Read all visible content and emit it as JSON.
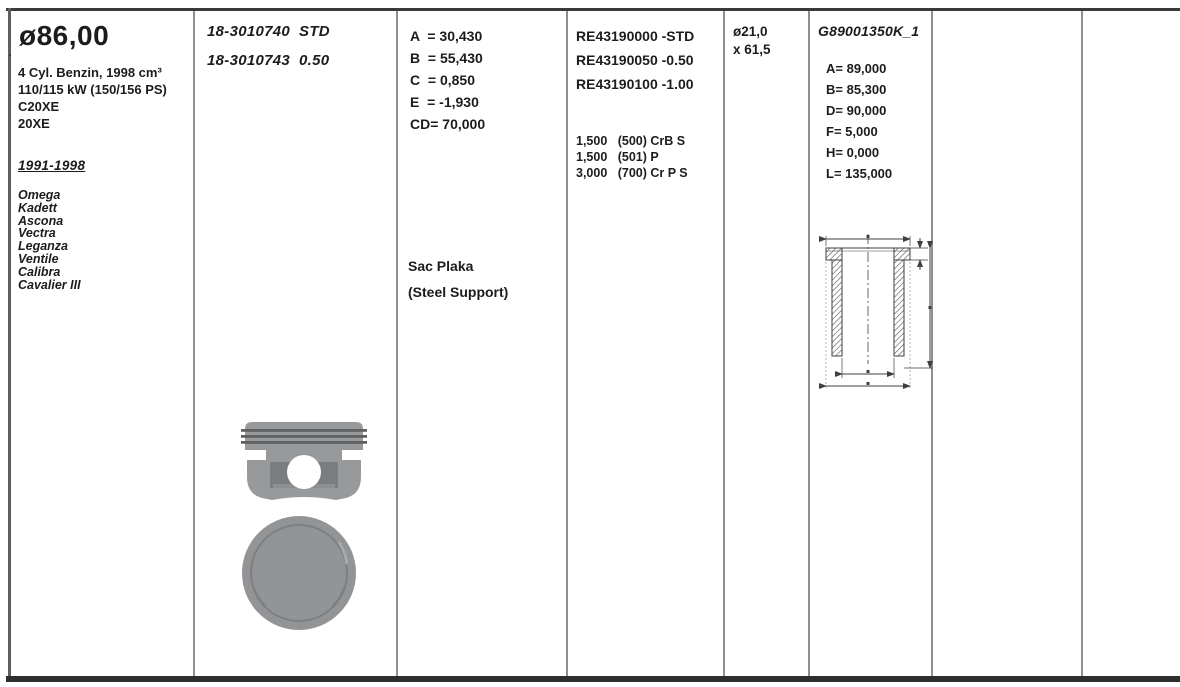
{
  "colors": {
    "text": "#1c1c1c",
    "grid_line": "#8f8f8f",
    "frame": "#3a3a3a",
    "piston_gray": "#97999b",
    "piston_dark_gray": "#7b7d7f",
    "drawing_ink": "#3f3f3f"
  },
  "col1": {
    "bore_diameter": "ø86,00",
    "spec_lines": [
      "4 Cyl. Benzin, 1998 cm³",
      "110/115 kW (150/156 PS)",
      "C20XE",
      "20XE"
    ],
    "year_range": "1991-1998",
    "models": [
      "Omega",
      "Kadett",
      "Ascona",
      "Vectra",
      "Leganza",
      "Ventile",
      "Calibra",
      "Cavalier III"
    ]
  },
  "col2": {
    "part_numbers": [
      "18-3010740  STD",
      "18-3010743  0.50"
    ]
  },
  "col3": {
    "dimensions": [
      "A  = 30,430",
      "B  = 55,430",
      "C  = 0,850",
      "E  = -1,930",
      "CD= 70,000"
    ],
    "support_line1": "Sac Plaka",
    "support_line2": "(Steel Support)"
  },
  "col4": {
    "ring_set_numbers": [
      "RE43190000 -STD",
      "RE43190050 -0.50",
      "RE43190100 -1.00"
    ],
    "ring_specs": [
      "1,500   (500) CrB S",
      "1,500   (501) P",
      "3,000   (700) Cr P S"
    ]
  },
  "col5": {
    "pin_line1": "ø21,0",
    "pin_line2": "x 61,5"
  },
  "col6": {
    "liner_code": "G89001350K_1",
    "liner_dimensions": [
      "A= 89,000",
      "B= 85,300",
      "D= 90,000",
      "F= 5,000",
      "H= 0,000",
      "L= 135,000"
    ]
  }
}
